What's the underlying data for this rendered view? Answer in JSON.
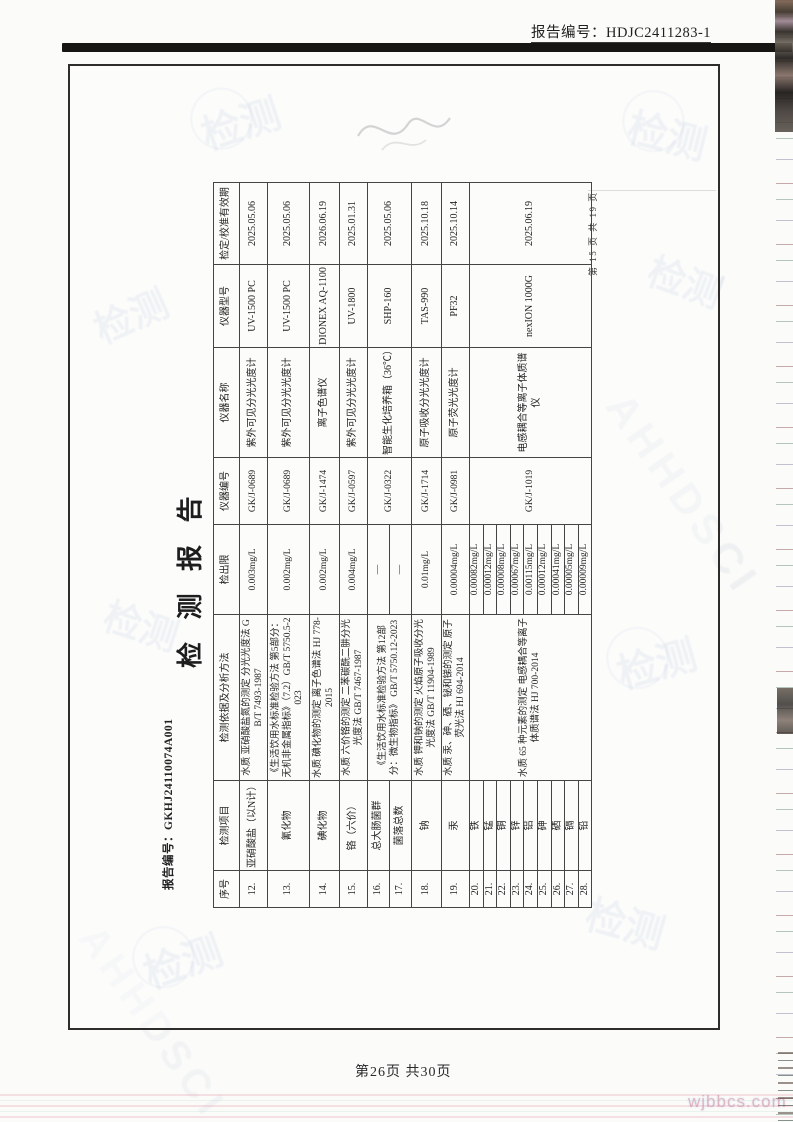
{
  "page": {
    "report_no_top": "报告编号：HDJC2411283-1",
    "title": "检 测 报 告",
    "inner_report_no": "报告编号：GKHJ24110074A001",
    "inner_page_marker": "第 15 页 共 19 页",
    "footer_page": "第26页 共30页"
  },
  "watermarks": {
    "stamp_text": "检测",
    "diag_text": "AHHDSCI",
    "bottom_text": "wjbbcs.com"
  },
  "colors": {
    "top_bar": "#171513",
    "frame_border": "#2e2d2b",
    "table_border": "#454545"
  },
  "table": {
    "headers": [
      "序号",
      "检测项目",
      "检测依据及分析方法",
      "检出限",
      "仪器编号",
      "仪器名称",
      "仪器型号",
      "检定/校准有效期"
    ],
    "rows": [
      {
        "no": "12.",
        "item": "亚硝酸盐（以N计）",
        "method": "水质 亚硝酸盐氮的测定 分光光度法 GB/T 7493-1987",
        "limit": "0.003mg/L",
        "instr_no": "GK/J-0689",
        "instr_name": "紫外可见分光光度计",
        "model": "UV-1500 PC",
        "validity": "2025.05.06"
      },
      {
        "no": "13.",
        "item": "氰化物",
        "method": "《生活饮用水标准检验方法 第5部分：无机非金属指标》（7.2）GB/T 5750.5-2023",
        "limit": "0.002mg/L",
        "instr_no": "GK/J-0689",
        "instr_name": "紫外可见分光光度计",
        "model": "UV-1500 PC",
        "validity": "2025.05.06"
      },
      {
        "no": "14.",
        "item": "碘化物",
        "method": "水质 碘化物的测定 离子色谱法 HJ 778-2015",
        "limit": "0.002mg/L",
        "instr_no": "GK/J-1474",
        "instr_name": "离子色谱仪",
        "model": "DIONEX AQ-1100",
        "validity": "2026.06.19"
      },
      {
        "no": "15.",
        "item": "铬（六价）",
        "method": "水质 六价铬的测定 二苯碳酰二肼分光光度法 GB/T 7467-1987",
        "limit": "0.004mg/L",
        "instr_no": "GK/J-0597",
        "instr_name": "紫外可见分光光度计",
        "model": "UV-1800",
        "validity": "2025.01.31"
      },
      {
        "no": "16.",
        "item": "总大肠菌群",
        "method": "《生活饮用水标准检验方法 第12部分：微生物指标》 GB/T 5750.12-2023",
        "limit": "—",
        "instr_no": "GK/J-0322",
        "instr_name": "智能生化培养箱（36℃）",
        "model": "SHP-160",
        "validity": "2025.05.06"
      },
      {
        "no": "17.",
        "item": "菌落总数",
        "limit": "—"
      },
      {
        "no": "18.",
        "item": "钠",
        "method": "水质 钾和钠的测定 火焰原子吸收分光光度法 GB/T 11904-1989",
        "limit": "0.01mg/L",
        "instr_no": "GK/J-1714",
        "instr_name": "原子吸收分光光度计",
        "model": "TAS-990",
        "validity": "2025.10.18"
      },
      {
        "no": "19.",
        "item": "汞",
        "method": "水质 汞、砷、硒、铋和锑的测定 原子荧光法 HJ 694-2014",
        "limit": "0.00004mg/L",
        "instr_no": "GK/J-0981",
        "instr_name": "原子荧光光度计",
        "model": "PF32",
        "validity": "2025.10.14"
      },
      {
        "no": "20.",
        "item": "铁",
        "method": "水质 65 种元素的测定 电感耦合等离子体质谱法 HJ 700-2014",
        "limit": "0.00082mg/L",
        "instr_no": "GK/J-1019",
        "instr_name": "电感耦合等离子体质谱仪",
        "model": "nexION 1000G",
        "validity": "2025.06.19"
      },
      {
        "no": "21.",
        "item": "锰",
        "limit": "0.00012mg/L"
      },
      {
        "no": "22.",
        "item": "铜",
        "limit": "0.00008mg/L"
      },
      {
        "no": "23.",
        "item": "锌",
        "limit": "0.00067mg/L"
      },
      {
        "no": "24.",
        "item": "铝",
        "limit": "0.00115mg/L"
      },
      {
        "no": "25.",
        "item": "砷",
        "limit": "0.00012mg/L"
      },
      {
        "no": "26.",
        "item": "硒",
        "limit": "0.00041mg/L"
      },
      {
        "no": "27.",
        "item": "镉",
        "limit": "0.00005mg/L"
      },
      {
        "no": "28.",
        "item": "铅",
        "limit": "0.00009mg/L"
      }
    ]
  }
}
